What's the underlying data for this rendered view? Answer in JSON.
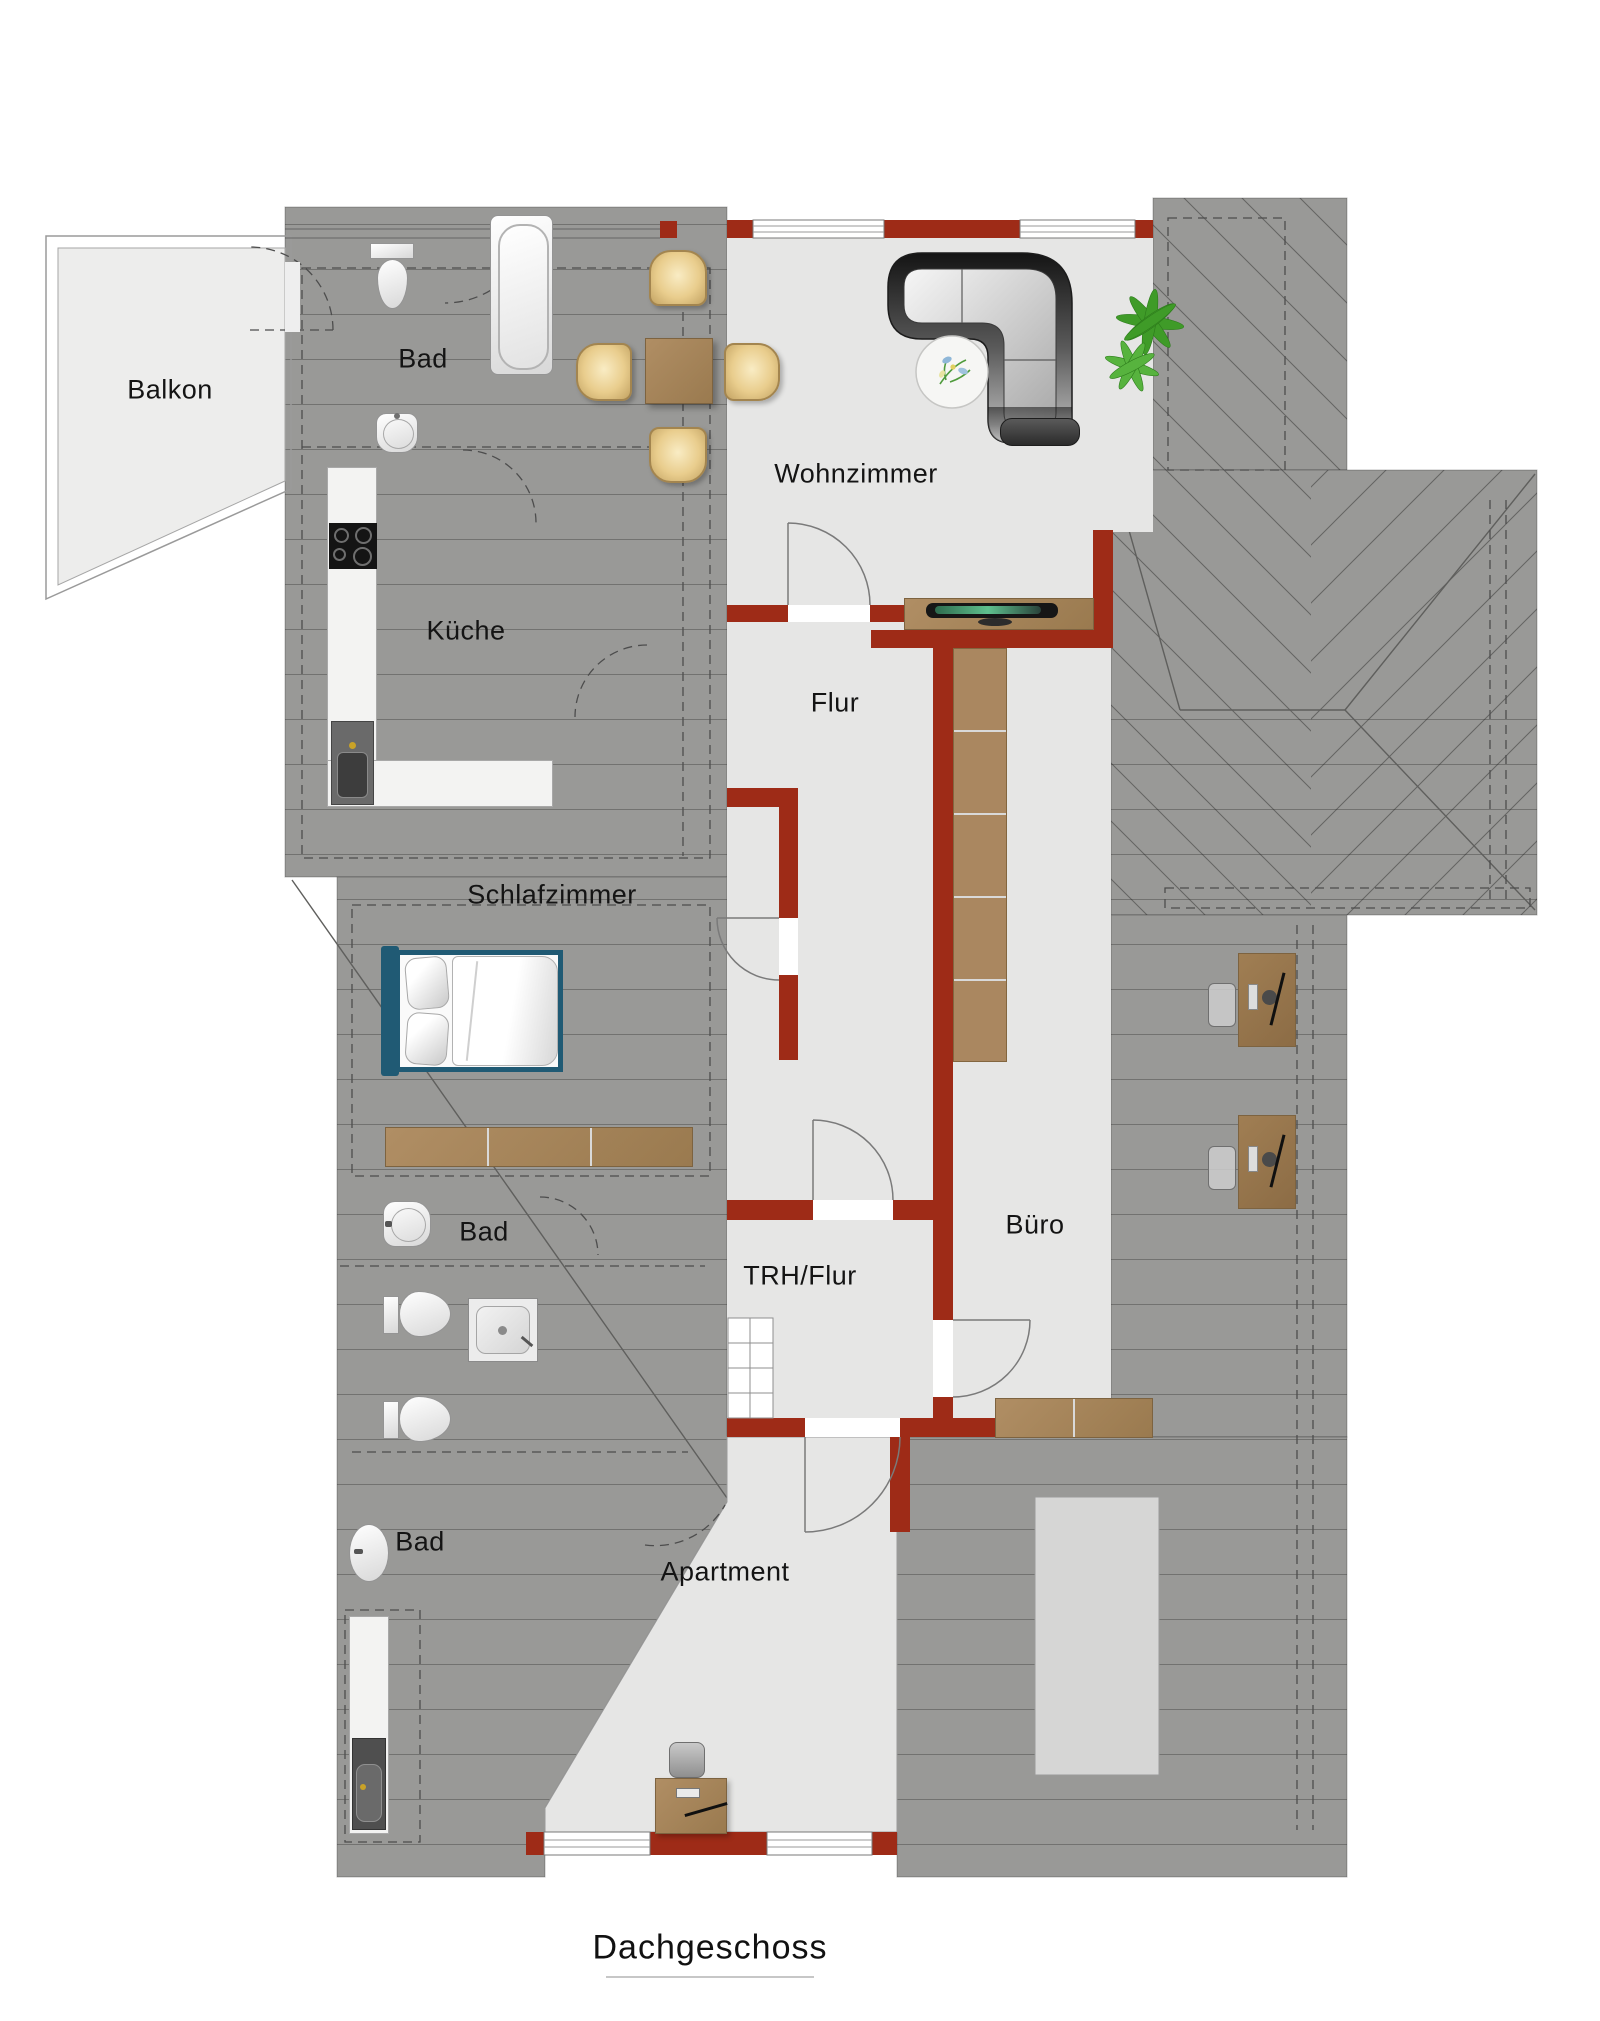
{
  "title": {
    "text": "Dachgeschoss"
  },
  "floor": "Dachgeschoss",
  "rooms": [
    {
      "id": "balkon",
      "label": "Balkon"
    },
    {
      "id": "bad-top",
      "label": "Bad"
    },
    {
      "id": "kueche",
      "label": "Küche"
    },
    {
      "id": "wohnzimmer",
      "label": "Wohnzimmer"
    },
    {
      "id": "flur",
      "label": "Flur"
    },
    {
      "id": "schlafzimmer",
      "label": "Schlafzimmer"
    },
    {
      "id": "bad-mitte",
      "label": "Bad"
    },
    {
      "id": "trh-flur",
      "label": "TRH/Flur"
    },
    {
      "id": "buero",
      "label": "Büro"
    },
    {
      "id": "bad-unten",
      "label": "Bad"
    },
    {
      "id": "apartment",
      "label": "Apartment"
    }
  ],
  "palette": {
    "roof_gray": "#999997",
    "room_light": "#e6e6e5",
    "balcony_light": "#ededec",
    "wall_red": "#9e2b17",
    "wood_brown": "#a5825a",
    "bed_frame_blue": "#205a74",
    "plant_green": "#3f9b28",
    "skylight_gray": "#d6d6d5"
  },
  "furniture": [
    "toilet",
    "washbasin",
    "bathtub",
    "dining-table",
    "dining-chairs",
    "corner-sofa",
    "round-rug",
    "plant",
    "kitchen-counter",
    "stove",
    "kitchen-sink",
    "tv-sideboard",
    "tv",
    "wardrobe",
    "double-bed",
    "sideboard",
    "shower",
    "desk-with-monitor",
    "office-chair",
    "staircase",
    "kitchenette-counter"
  ]
}
